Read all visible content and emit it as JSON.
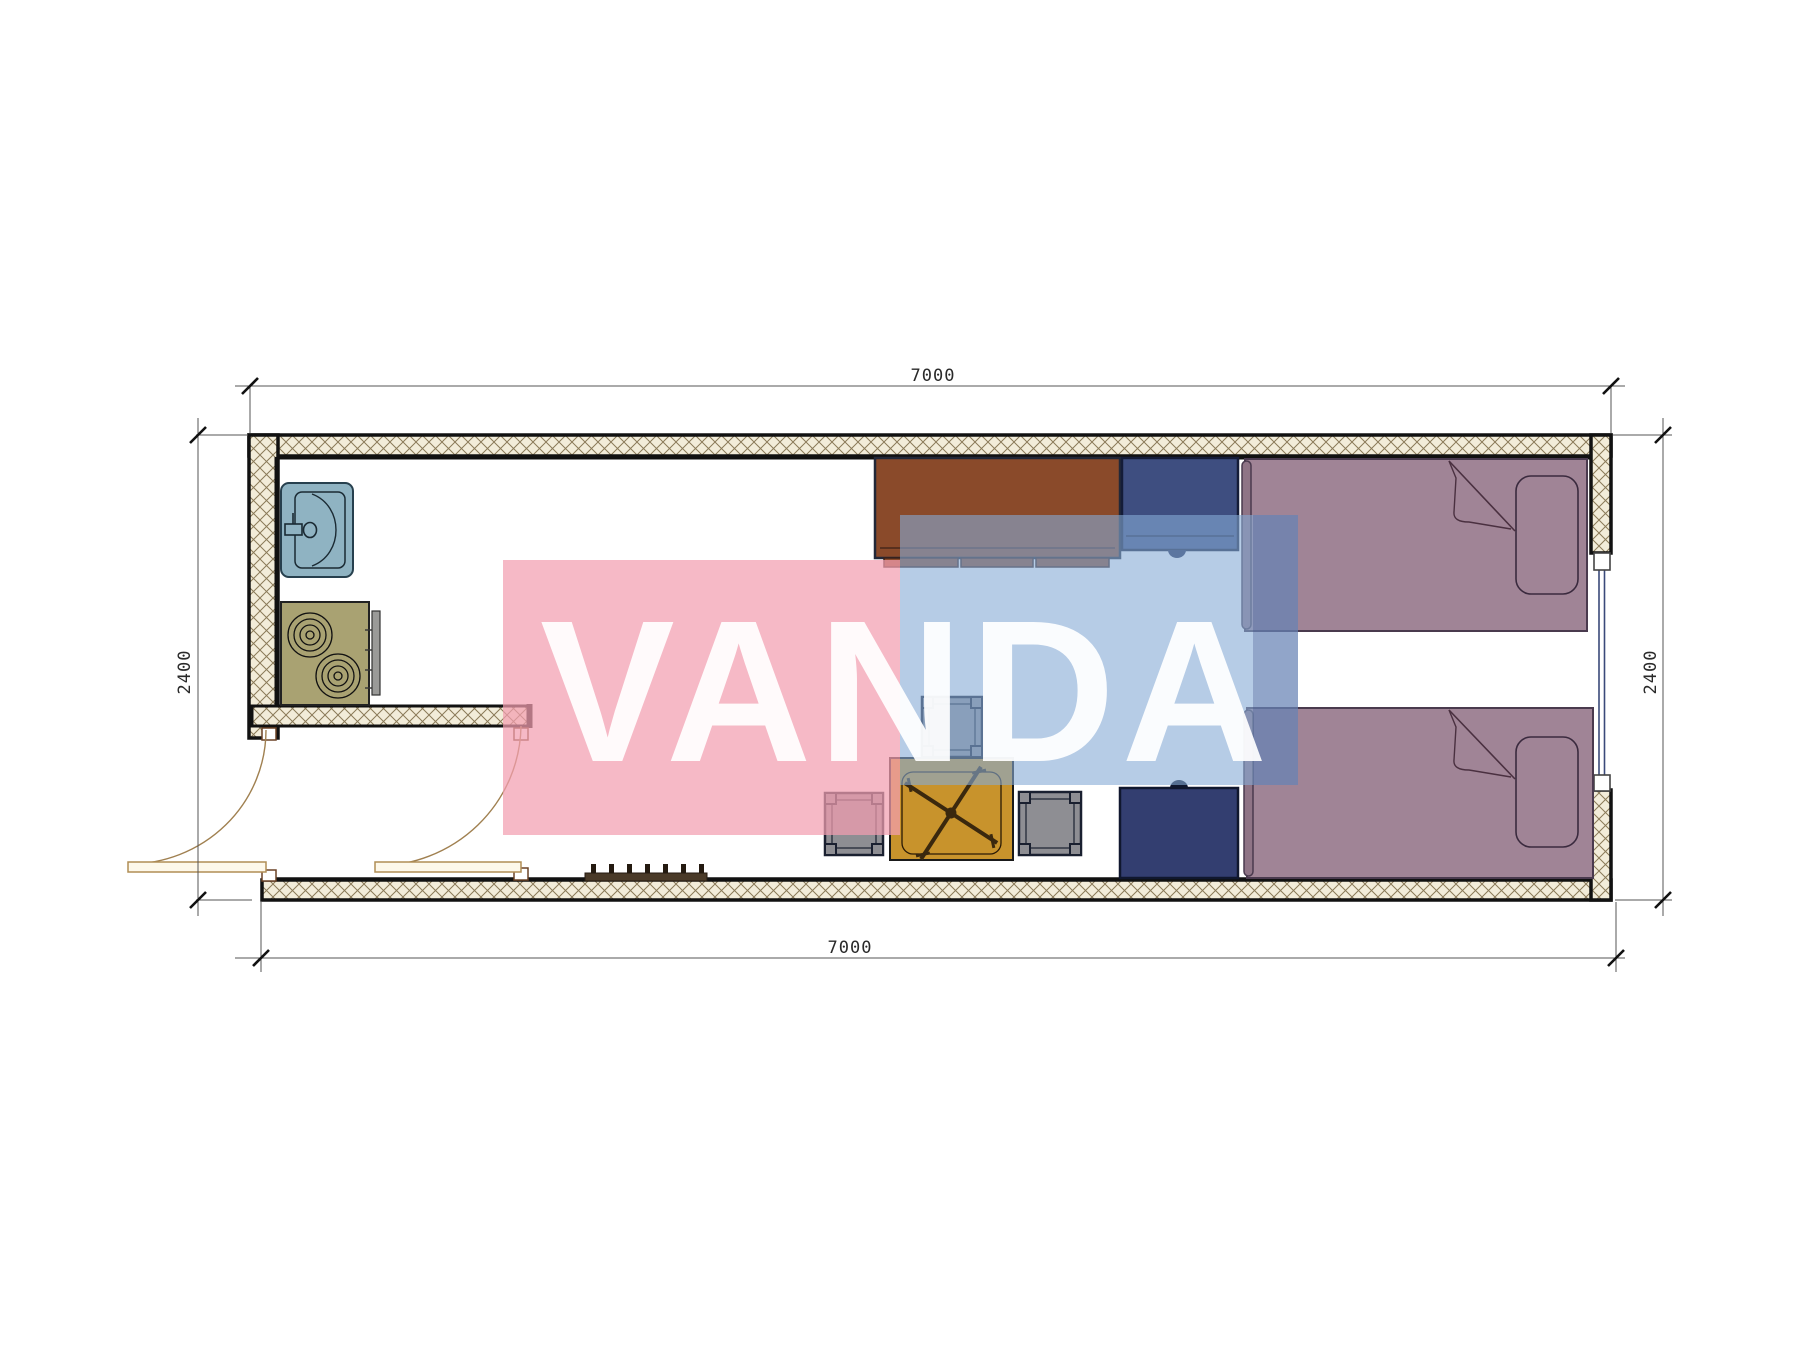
{
  "watermark": {
    "text": "VANDA",
    "pink_color": "#f6bac6",
    "blue_color": "#bccee6"
  },
  "dimensions": {
    "top_width": "7000",
    "bottom_width": "7000",
    "left_height": "2400",
    "right_height": "2400"
  },
  "plan": {
    "type": "floor-plan",
    "items": [
      {
        "name": "sink",
        "color": "#8fb3c2"
      },
      {
        "name": "stove",
        "color": "#a9a272"
      },
      {
        "name": "desk",
        "color": "#8a4a2a"
      },
      {
        "name": "chair-top",
        "color": "#3e4e80"
      },
      {
        "name": "bed-top",
        "color": "#a08496"
      },
      {
        "name": "bed-bottom",
        "color": "#a08496"
      },
      {
        "name": "stool-1",
        "color": "#8e8e93"
      },
      {
        "name": "stool-2",
        "color": "#8e8e93"
      },
      {
        "name": "stool-3",
        "color": "#8e8e93"
      },
      {
        "name": "office-table",
        "color": "#c8932c"
      },
      {
        "name": "cabinet-bottom",
        "color": "#333e70"
      },
      {
        "name": "coat-rack",
        "color": "#4a3a28"
      },
      {
        "name": "door-left",
        "swing": "outward"
      },
      {
        "name": "door-inner",
        "swing": "inward"
      },
      {
        "name": "window-right",
        "glass_color": "#3a4a7a"
      }
    ],
    "wall_hatch_color": "#f2ecd9",
    "wall_line_color": "#111111"
  }
}
